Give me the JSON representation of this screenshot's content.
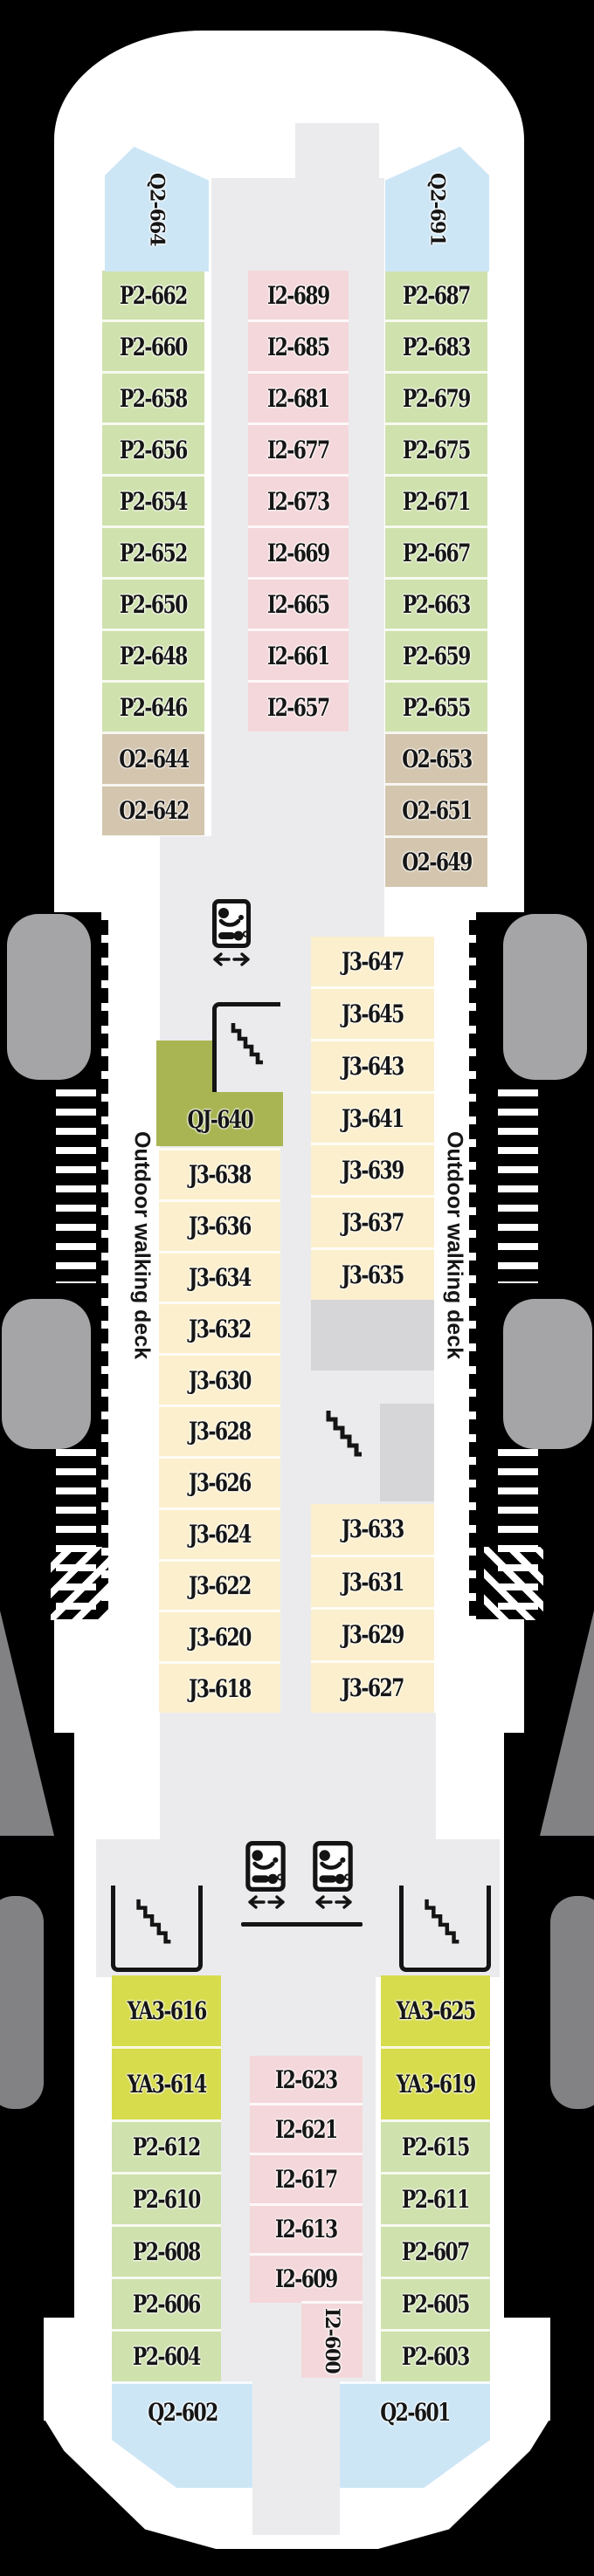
{
  "plan": {
    "colors": {
      "background": "#000000",
      "hull": "#ffffff",
      "corridor": "#ebebed",
      "structure": "#d6d6d8",
      "boat": "#a5a5a7",
      "sponson": "#828285",
      "ink": "#141414",
      "green": "#cfe1ad",
      "pink": "#f4d7da",
      "blue": "#cde6f6",
      "tan": "#d3c5ae",
      "cream": "#fbefcd",
      "olive": "#a8b552",
      "yellow": "#d7dc4d"
    },
    "walkway_label_left": "Outdoor walking deck",
    "walkway_label_right": "Outdoor walking deck",
    "icons": {
      "restroom": "restroom-icon",
      "stairs": "stairs-icon",
      "arrows": "left-right-arrows-icon"
    },
    "columns": [
      {
        "id": "fwd-port-main",
        "cells": [
          {
            "label": "P2-662",
            "color": "green"
          },
          {
            "label": "P2-660",
            "color": "green"
          },
          {
            "label": "P2-658",
            "color": "green"
          },
          {
            "label": "P2-656",
            "color": "green"
          },
          {
            "label": "P2-654",
            "color": "green"
          },
          {
            "label": "P2-652",
            "color": "green"
          },
          {
            "label": "P2-650",
            "color": "green"
          },
          {
            "label": "P2-648",
            "color": "green"
          },
          {
            "label": "P2-646",
            "color": "green"
          }
        ]
      },
      {
        "id": "fwd-port-tan",
        "cells": [
          {
            "label": "O2-644",
            "color": "tan"
          },
          {
            "label": "O2-642",
            "color": "tan"
          }
        ]
      },
      {
        "id": "fwd-center",
        "cells": [
          {
            "label": "I2-689",
            "color": "pink"
          },
          {
            "label": "I2-685",
            "color": "pink"
          },
          {
            "label": "I2-681",
            "color": "pink"
          },
          {
            "label": "I2-677",
            "color": "pink"
          },
          {
            "label": "I2-673",
            "color": "pink"
          },
          {
            "label": "I2-669",
            "color": "pink"
          },
          {
            "label": "I2-665",
            "color": "pink"
          },
          {
            "label": "I2-661",
            "color": "pink"
          },
          {
            "label": "I2-657",
            "color": "pink"
          }
        ]
      },
      {
        "id": "fwd-stbd-main",
        "cells": [
          {
            "label": "P2-687",
            "color": "green"
          },
          {
            "label": "P2-683",
            "color": "green"
          },
          {
            "label": "P2-679",
            "color": "green"
          },
          {
            "label": "P2-675",
            "color": "green"
          },
          {
            "label": "P2-671",
            "color": "green"
          },
          {
            "label": "P2-667",
            "color": "green"
          },
          {
            "label": "P2-663",
            "color": "green"
          },
          {
            "label": "P2-659",
            "color": "green"
          },
          {
            "label": "P2-655",
            "color": "green"
          }
        ]
      },
      {
        "id": "fwd-stbd-tan",
        "cells": [
          {
            "label": "O2-653",
            "color": "tan"
          },
          {
            "label": "O2-651",
            "color": "tan"
          },
          {
            "label": "O2-649",
            "color": "tan"
          }
        ]
      },
      {
        "id": "mid-port",
        "cells": [
          {
            "label": "J3-638",
            "color": "cream"
          },
          {
            "label": "J3-636",
            "color": "cream"
          },
          {
            "label": "J3-634",
            "color": "cream"
          },
          {
            "label": "J3-632",
            "color": "cream"
          },
          {
            "label": "J3-630",
            "color": "cream"
          },
          {
            "label": "J3-628",
            "color": "cream"
          },
          {
            "label": "J3-626",
            "color": "cream"
          },
          {
            "label": "J3-624",
            "color": "cream"
          },
          {
            "label": "J3-622",
            "color": "cream"
          },
          {
            "label": "J3-620",
            "color": "cream"
          },
          {
            "label": "J3-618",
            "color": "cream"
          }
        ]
      },
      {
        "id": "mid-stbd-a",
        "cells": [
          {
            "label": "J3-647",
            "color": "cream"
          },
          {
            "label": "J3-645",
            "color": "cream"
          },
          {
            "label": "J3-643",
            "color": "cream"
          },
          {
            "label": "J3-641",
            "color": "cream"
          },
          {
            "label": "J3-639",
            "color": "cream"
          },
          {
            "label": "J3-637",
            "color": "cream"
          },
          {
            "label": "J3-635",
            "color": "cream"
          }
        ]
      },
      {
        "id": "mid-stbd-b",
        "cells": [
          {
            "label": "J3-633",
            "color": "cream"
          },
          {
            "label": "J3-631",
            "color": "cream"
          },
          {
            "label": "J3-629",
            "color": "cream"
          },
          {
            "label": "J3-627",
            "color": "cream"
          }
        ]
      },
      {
        "id": "aft-port-ya",
        "cells": [
          {
            "label": "YA3-616",
            "color": "yellow"
          },
          {
            "label": "YA3-614",
            "color": "yellow"
          }
        ]
      },
      {
        "id": "aft-port-green",
        "cells": [
          {
            "label": "P2-612",
            "color": "green"
          },
          {
            "label": "P2-610",
            "color": "green"
          },
          {
            "label": "P2-608",
            "color": "green"
          },
          {
            "label": "P2-606",
            "color": "green"
          },
          {
            "label": "P2-604",
            "color": "green"
          }
        ]
      },
      {
        "id": "aft-center",
        "cells": [
          {
            "label": "I2-623",
            "color": "pink"
          },
          {
            "label": "I2-621",
            "color": "pink"
          },
          {
            "label": "I2-617",
            "color": "pink"
          },
          {
            "label": "I2-613",
            "color": "pink"
          },
          {
            "label": "I2-609",
            "color": "pink"
          }
        ]
      },
      {
        "id": "aft-stbd-ya",
        "cells": [
          {
            "label": "YA3-625",
            "color": "yellow"
          },
          {
            "label": "YA3-619",
            "color": "yellow"
          }
        ]
      },
      {
        "id": "aft-stbd-green",
        "cells": [
          {
            "label": "P2-615",
            "color": "green"
          },
          {
            "label": "P2-611",
            "color": "green"
          },
          {
            "label": "P2-607",
            "color": "green"
          },
          {
            "label": "P2-605",
            "color": "green"
          },
          {
            "label": "P2-603",
            "color": "green"
          }
        ]
      }
    ],
    "blocks": [
      {
        "id": "Q2-664",
        "label": "Q2-664",
        "color": "blue"
      },
      {
        "id": "Q2-691",
        "label": "Q2-691",
        "color": "blue"
      },
      {
        "id": "QJ-640",
        "label": "QJ-640",
        "color": "olive"
      },
      {
        "id": "I2-600",
        "label": "I2-600",
        "color": "pink"
      },
      {
        "id": "Q2-602",
        "label": "Q2-602",
        "color": "blue"
      },
      {
        "id": "Q2-601",
        "label": "Q2-601",
        "color": "blue"
      }
    ]
  }
}
